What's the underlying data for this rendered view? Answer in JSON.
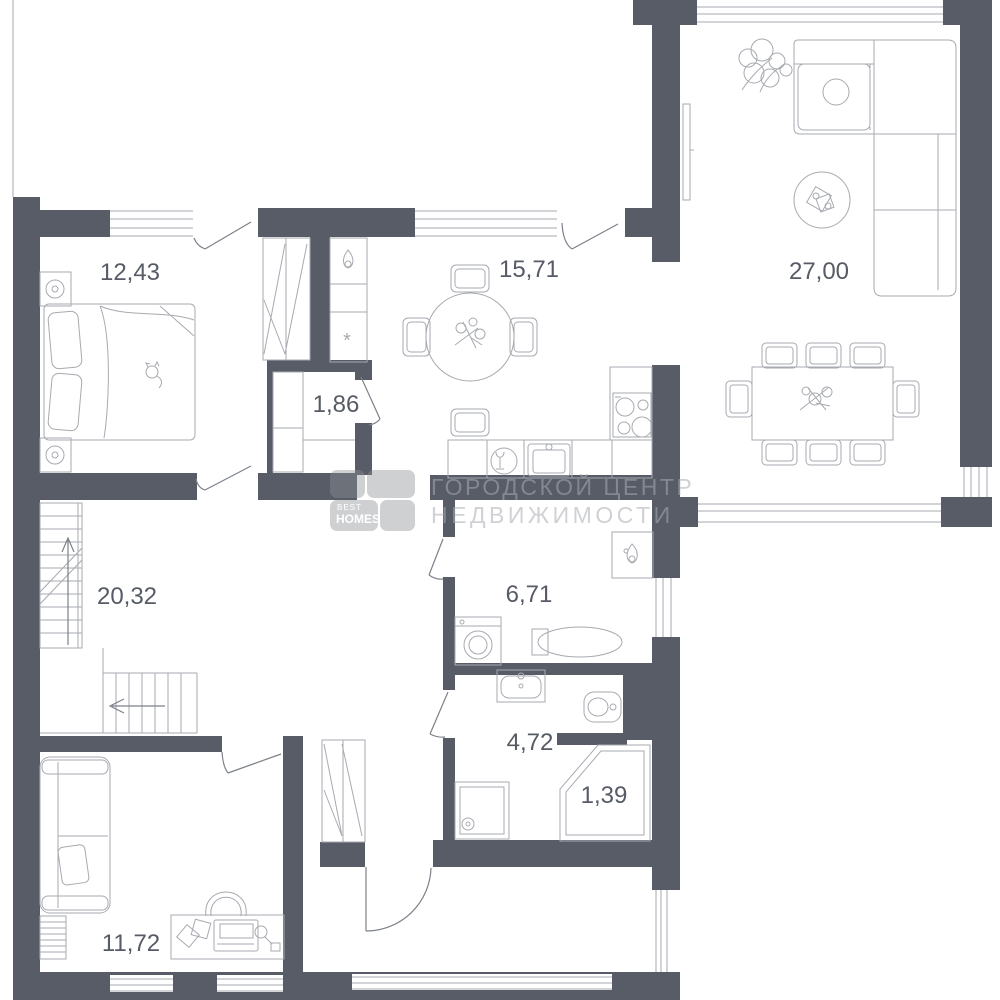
{
  "plan": {
    "kind": "apartment-floor-plan"
  },
  "rooms": [
    {
      "id": "bedroom",
      "area": "12,43"
    },
    {
      "id": "kitchen",
      "area": "15,71"
    },
    {
      "id": "living-room",
      "area": "27,00"
    },
    {
      "id": "closet",
      "area": "1,86"
    },
    {
      "id": "hall",
      "area": "20,32"
    },
    {
      "id": "laundry",
      "area": "6,71"
    },
    {
      "id": "bathroom",
      "area": "4,72"
    },
    {
      "id": "shower-cabin",
      "area": "1,39"
    },
    {
      "id": "office",
      "area": "11,72"
    }
  ],
  "kitchen": {
    "vent_symbol": "*"
  },
  "watermark": {
    "line1": "ГОРОДСКОЙ ЦЕНТР",
    "line2": "НЕДВИЖИМОСТИ"
  },
  "logo": {
    "top": "BEST",
    "bottom": "HOMES"
  },
  "colors": {
    "wall": "#575c66",
    "line": "#a7aab0",
    "door": "#7c818a",
    "label": "#565b65",
    "watermark": "rgba(168,171,178,0.55)",
    "logo_square": "rgba(140,142,147,0.42)",
    "logo_text": "#ffffff"
  }
}
